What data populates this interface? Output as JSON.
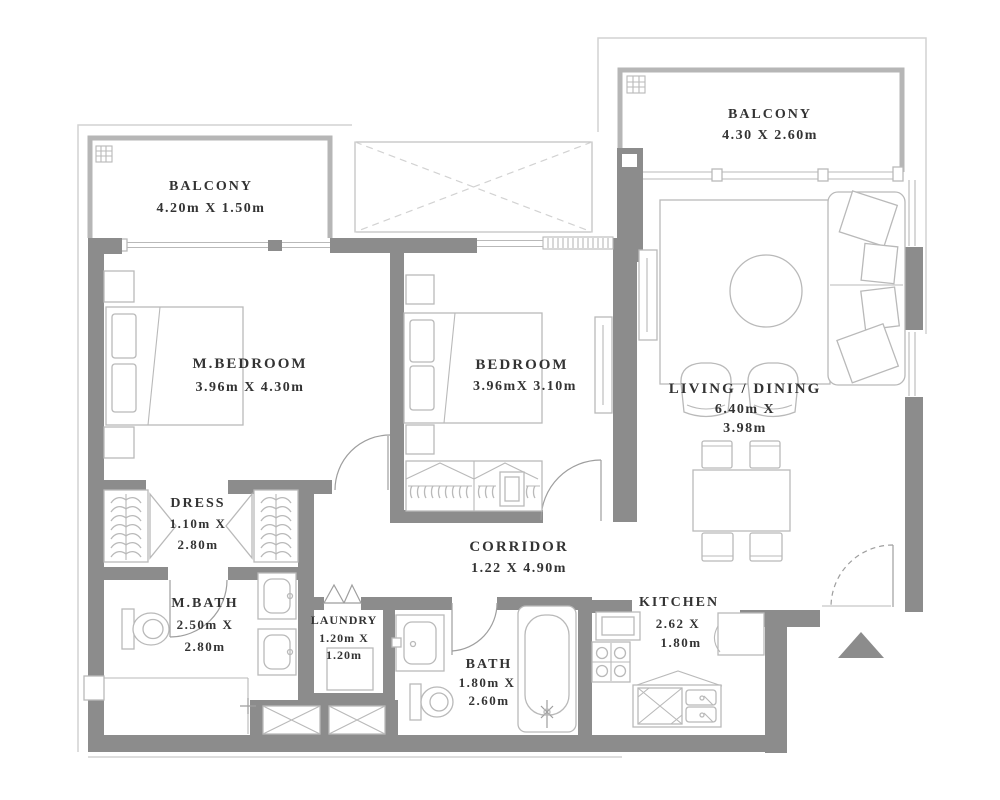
{
  "colors": {
    "background": "#ffffff",
    "wall": "#8c8c8c",
    "wall_light": "#b6b6b6",
    "line": "#b9b9b9",
    "line_soft": "#d2d2d2",
    "line_dark": "#9e9e9e",
    "text": "#333333"
  },
  "rooms": {
    "balcony_left": {
      "name": "BALCONY",
      "dims": "4.20m X 1.50m"
    },
    "balcony_right": {
      "name": "BALCONY",
      "dims": "4.30 X 2.60m"
    },
    "m_bedroom": {
      "name": "M.BEDROOM",
      "dims": "3.96m X 4.30m"
    },
    "bedroom": {
      "name": "BEDROOM",
      "dims": "3.96mX 3.10m"
    },
    "living_dining": {
      "name": "LIVING / DINING",
      "dims1": "6.40m X",
      "dims2": "3.98m"
    },
    "dress": {
      "name": "DRESS",
      "dims1": "1.10m X",
      "dims2": "2.80m"
    },
    "corridor": {
      "name": "CORRIDOR",
      "dims": "1.22 X 4.90m"
    },
    "m_bath": {
      "name": "M.BATH",
      "dims1": "2.50m X",
      "dims2": "2.80m"
    },
    "laundry": {
      "name": "LAUNDRY",
      "dims1": "1.20m X",
      "dims2": "1.20m"
    },
    "bath": {
      "name": "BATH",
      "dims1": "1.80m X",
      "dims2": "2.60m"
    },
    "kitchen": {
      "name": "KITCHEN",
      "dims1": "2.62 X",
      "dims2": "1.80m"
    }
  }
}
